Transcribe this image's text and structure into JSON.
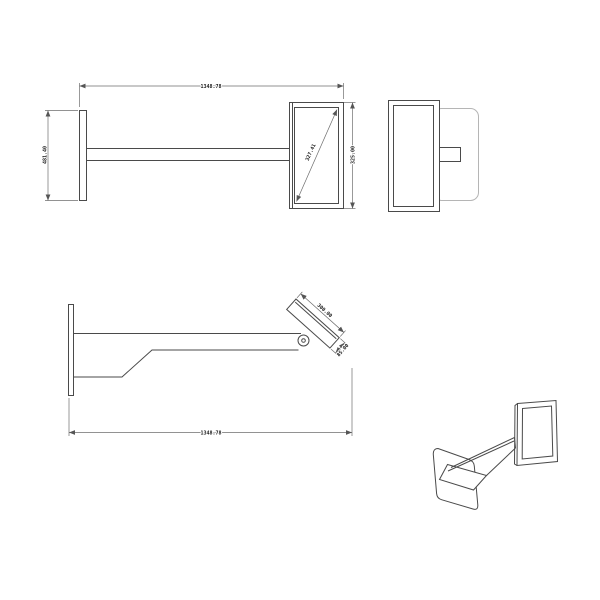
{
  "colors": {
    "background": "#ffffff",
    "geometry_line": "#4a4a4a",
    "light_geometry_line": "#b5b5b5",
    "dimension_line": "#6e6e6e",
    "dimension_text": "#1a1a1a"
  },
  "views": {
    "top_left_front": {
      "dims": {
        "overall_width": "1348.78",
        "wall_plate_height": "481.40",
        "panel_height": "325.00",
        "panel_diagonal": "327.41"
      }
    },
    "middle_profile": {
      "dims": {
        "panel_length": "300.00",
        "panel_thickness": "85.00",
        "overall_length": "1348.78"
      }
    }
  }
}
